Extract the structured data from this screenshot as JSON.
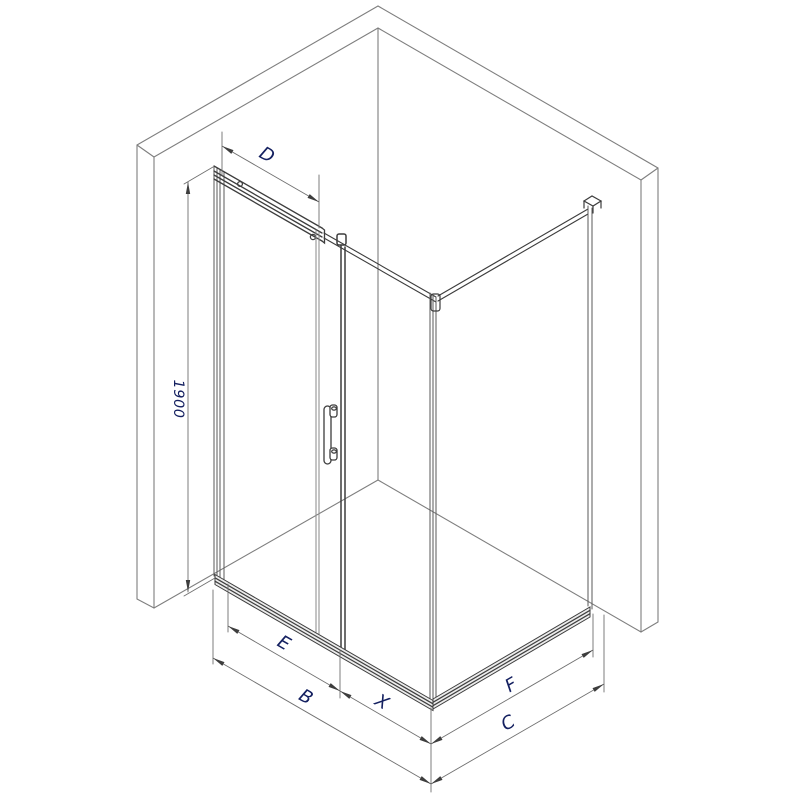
{
  "drawing": {
    "description": "Isometric technical drawing of a corner shower enclosure with sliding door between two walls",
    "background_color": "#ffffff",
    "wall_line_color": "#7f7f7f",
    "frame_dark_color": "#3d3d3d",
    "glass_line_color": "#8a8a8a",
    "dimension_line_color": "#707070",
    "label_color": "#142060",
    "labels": {
      "door_top_width": "D",
      "height": "1900",
      "glass_width": "E",
      "front_total_width": "B",
      "opening_width": "X",
      "side_glass_width": "F",
      "side_total_depth": "C"
    }
  }
}
